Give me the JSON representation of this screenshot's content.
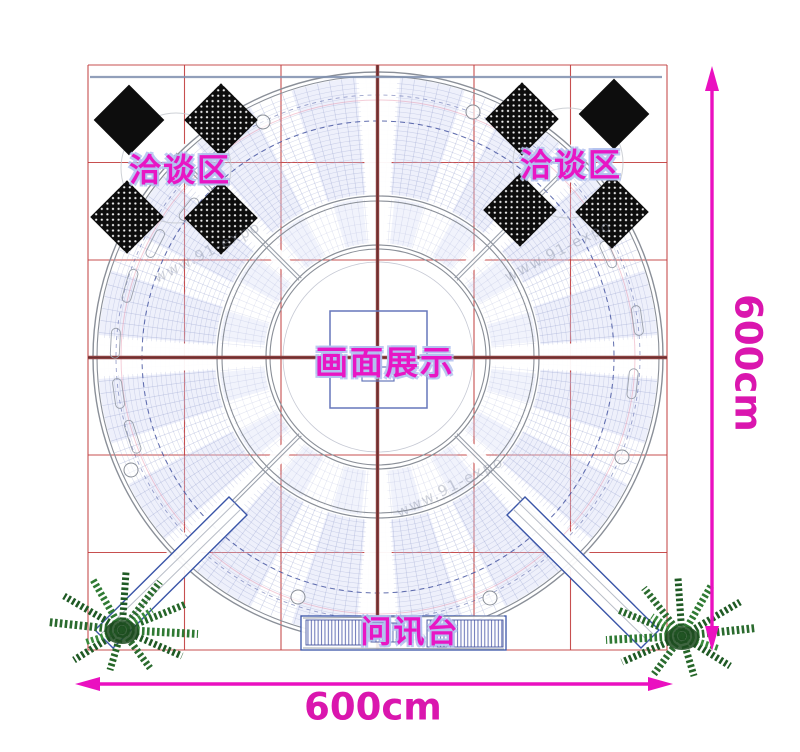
{
  "plan": {
    "areas": [
      {
        "id": "negotiation-left",
        "label": "洽谈区"
      },
      {
        "id": "negotiation-right",
        "label": "洽谈区"
      },
      {
        "id": "display-center",
        "label": "画面展示"
      },
      {
        "id": "info-desk",
        "label": "问讯台"
      }
    ],
    "dimensions": {
      "width": "600cm",
      "height": "600cm"
    },
    "watermark": "www.91-expo",
    "colors": {
      "grid_red": "#c23c3c",
      "beam_maroon": "#8a4040",
      "dimension_magenta": "#da16ae",
      "label_magenta": "#e816c4",
      "structure_blue": "#3a55a8",
      "dashed_navy": "#3a4a9a",
      "mesh_lavender": "#9ea8d2",
      "furniture_black": "#0d0d0d",
      "plant_green": "#2a6b2e",
      "wall_bluegray": "#7e8fae"
    }
  }
}
